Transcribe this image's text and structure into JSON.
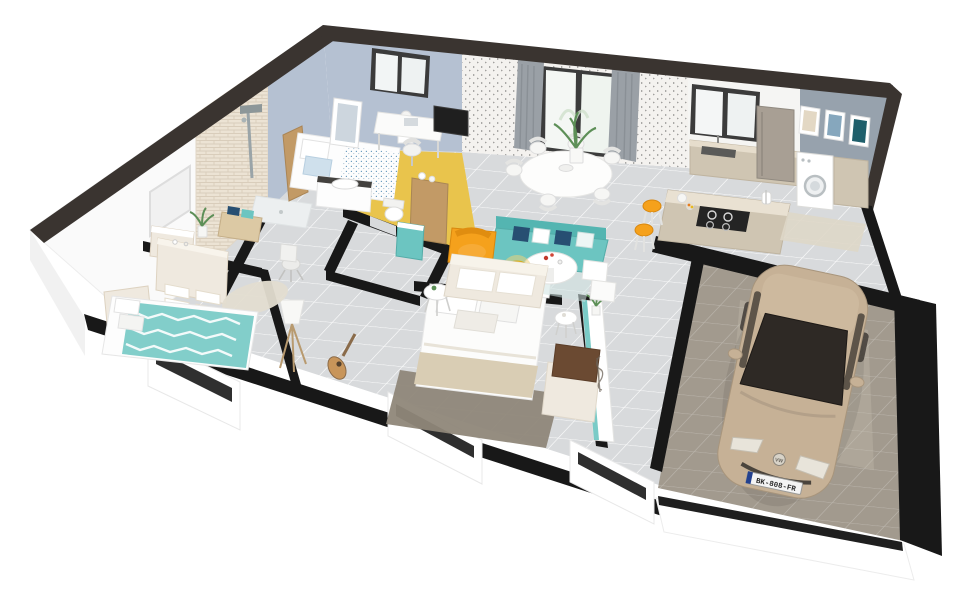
{
  "render": {
    "style": "isometric-3d-floorplan-render",
    "background": "#ffffff",
    "license_plate": "BK-808-FR",
    "car_badge": "VW",
    "watermark": "signature-squiggle"
  },
  "palette": {
    "wallTop": "#3a3430",
    "partition": "#181818",
    "floor": "#d8dadc",
    "grout": "#ffffff",
    "yellowFloor": "#e9c44c",
    "blueWall": "#b5c1d2",
    "grayWall": "#97a2ad",
    "wallpaperBase": "#f4f2ef",
    "brick": "#ece3d4",
    "wood": "#c29a66",
    "lightWood": "#dcc9a4",
    "beige": "#cfc5b2",
    "taupe": "#a89f94",
    "teal": "#6cc5c1",
    "navy": "#274f72",
    "orange": "#f5a11c",
    "yellow": "#f2c62e",
    "cream": "#efe9df",
    "carBody": "#c6b196",
    "carGlass": "#2e2925",
    "garageFloor": "#a29a8e",
    "rugDark": "#8f8779",
    "rugLight": "#e3ddd0",
    "plant": "#5d8f57",
    "curtain": "#9aa0a6"
  },
  "rooms": [
    {
      "name": "bathroom",
      "items": [
        "brick accent wall",
        "shower column",
        "shower tray",
        "wood bench with towels",
        "vanity",
        "plant",
        "wall niche"
      ]
    },
    {
      "name": "master bedroom",
      "floor": "yellow",
      "items": [
        "double bed",
        "window",
        "leaning mirror",
        "desk",
        "chair",
        "nightstand lamp",
        "foot chest",
        "wood sideboard",
        "tv"
      ]
    },
    {
      "name": "wc",
      "items": [
        "toilet",
        "teal vanity"
      ]
    },
    {
      "name": "hallway",
      "items": [
        "desk chair",
        "tripod floor lamp",
        "guitar"
      ]
    },
    {
      "name": "bedroom-left",
      "items": [
        "double bed with teal chevron duvet",
        "dresser",
        "shag rug"
      ]
    },
    {
      "name": "bedroom-middle",
      "items": [
        "double bed",
        "white headboard",
        "dark rug",
        "two round side tables",
        "long sideboard with plant",
        "bench with brown cushion"
      ]
    },
    {
      "name": "living-dining",
      "items": [
        "teal sofa",
        "cream sofa",
        "orange armchair",
        "round pedestal coffee table",
        "yellow side table",
        "two white poufs",
        "oval dining table",
        "six white chairs",
        "tall plant",
        "glass door with gray curtains"
      ]
    },
    {
      "name": "kitchen",
      "items": [
        "wall cabinets with sink",
        "window",
        "fridge",
        "island with cooktop",
        "two orange bar stools",
        "paper towel roll"
      ]
    },
    {
      "name": "laundry",
      "items": [
        "washing machine",
        "side cabinet",
        "rug",
        "three wall frames"
      ]
    },
    {
      "name": "garage",
      "items": [
        "parked car"
      ]
    }
  ]
}
